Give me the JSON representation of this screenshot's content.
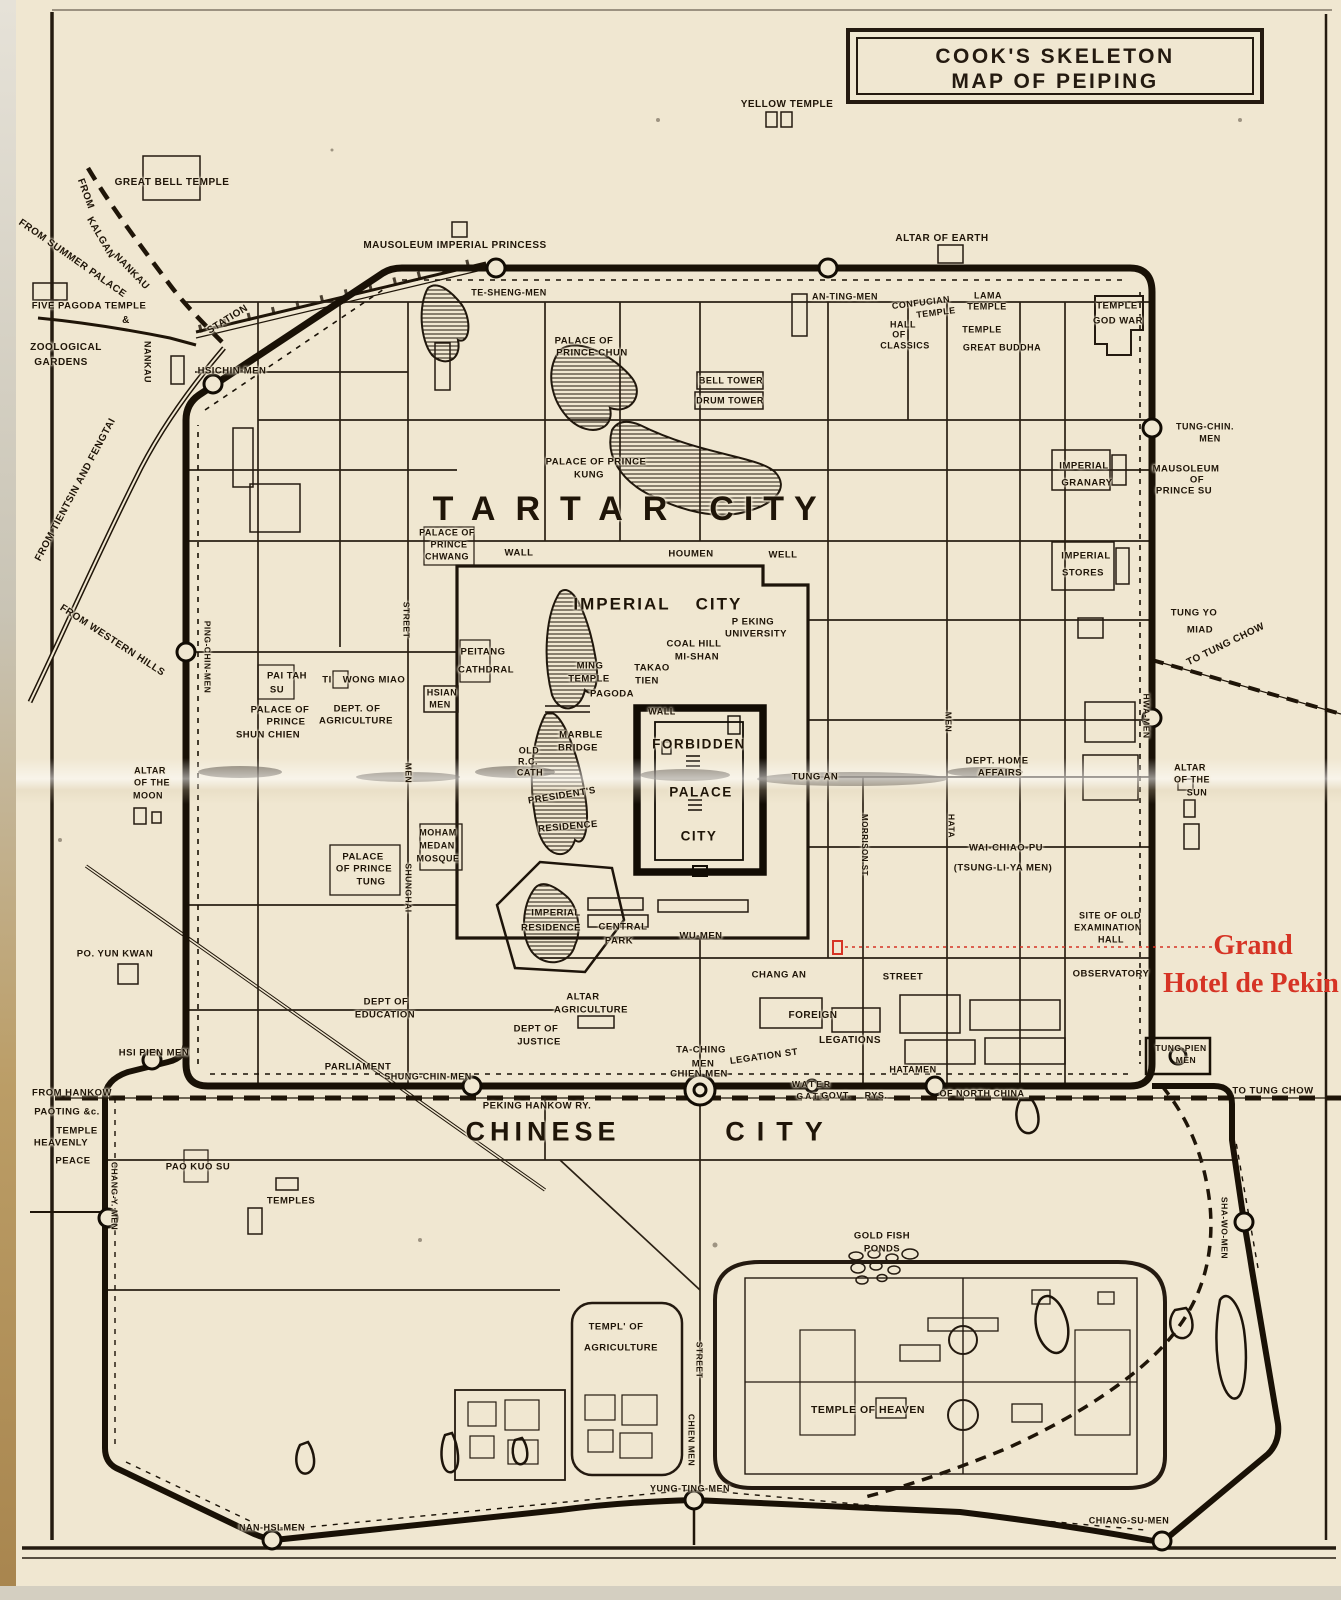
{
  "page": {
    "paper": "#f0e7d1",
    "ink": "#1f1508",
    "red": "#d63425"
  },
  "title": {
    "line1": "COOK'S SKELETON",
    "line2": "MAP OF PEIPING"
  },
  "hotel": {
    "line1": "Grand",
    "line2": "Hotel de Pekin"
  },
  "labels": [
    {
      "t": "YELLOW TEMPLE",
      "x": 787,
      "y": 105,
      "s": 10
    },
    {
      "t": "GREAT BELL TEMPLE",
      "x": 172,
      "y": 183,
      "s": 10
    },
    {
      "t": "MAUSOLEUM IMPERIAL PRINCESS",
      "x": 455,
      "y": 246,
      "s": 10
    },
    {
      "t": "ALTAR OF EARTH",
      "x": 942,
      "y": 239,
      "s": 10
    },
    {
      "t": "FROM",
      "x": 85,
      "y": 194,
      "s": 10,
      "r": 70
    },
    {
      "t": "KALGAN",
      "x": 100,
      "y": 238,
      "s": 10,
      "r": 60
    },
    {
      "t": "NANKAU",
      "x": 131,
      "y": 272,
      "s": 10,
      "r": 46
    },
    {
      "t": "FROM SUMMER PALACE",
      "x": 72,
      "y": 259,
      "s": 10,
      "r": 35
    },
    {
      "t": "&",
      "x": 126,
      "y": 321,
      "s": 10
    },
    {
      "t": "FIVE PAGODA TEMPLE",
      "x": 89,
      "y": 306,
      "s": 9.5
    },
    {
      "t": "ZOOLOGICAL",
      "x": 66,
      "y": 348,
      "s": 10
    },
    {
      "t": "GARDENS",
      "x": 61,
      "y": 363,
      "s": 10
    },
    {
      "t": "STATION",
      "x": 228,
      "y": 320,
      "s": 10,
      "r": -32
    },
    {
      "t": "NANKAU",
      "x": 147,
      "y": 362,
      "s": 9,
      "v": 1
    },
    {
      "t": "HSICHIN-MEN",
      "x": 232,
      "y": 371,
      "s": 9.5
    },
    {
      "t": "FROM TIENTSIN AND FENGTAI",
      "x": 76,
      "y": 490,
      "s": 10,
      "r": -62
    },
    {
      "t": "FROM WESTERN HILLS",
      "x": 112,
      "y": 641,
      "s": 10,
      "r": 33
    },
    {
      "t": "TE-SHENG-MEN",
      "x": 509,
      "y": 293,
      "s": 9
    },
    {
      "t": "AN-TING-MEN",
      "x": 845,
      "y": 297,
      "s": 9
    },
    {
      "t": "CONFUCIAN",
      "x": 921,
      "y": 303,
      "s": 9,
      "r": -7
    },
    {
      "t": "TEMPLE",
      "x": 936,
      "y": 313,
      "s": 9,
      "r": -7
    },
    {
      "t": "LAMA",
      "x": 988,
      "y": 296,
      "s": 9
    },
    {
      "t": "TEMPLE",
      "x": 987,
      "y": 307,
      "s": 9
    },
    {
      "t": "HALL",
      "x": 903,
      "y": 325,
      "s": 9
    },
    {
      "t": "OF",
      "x": 899,
      "y": 335,
      "s": 9
    },
    {
      "t": "CLASSICS",
      "x": 905,
      "y": 346,
      "s": 9
    },
    {
      "t": "TEMPLE",
      "x": 982,
      "y": 330,
      "s": 9
    },
    {
      "t": "GREAT  BUDDHA",
      "x": 1002,
      "y": 348,
      "s": 9
    },
    {
      "t": "TEMPLE",
      "x": 1117,
      "y": 306,
      "s": 9.5
    },
    {
      "t": "GOD WAR",
      "x": 1118,
      "y": 321,
      "s": 9.5
    },
    {
      "t": "TUNG-CHIN.",
      "x": 1205,
      "y": 427,
      "s": 9
    },
    {
      "t": "MEN",
      "x": 1210,
      "y": 439,
      "s": 9
    },
    {
      "t": "MAUSOLEUM",
      "x": 1186,
      "y": 469,
      "s": 9.5
    },
    {
      "t": "OF",
      "x": 1197,
      "y": 480,
      "s": 9.5
    },
    {
      "t": "PRINCE SU",
      "x": 1184,
      "y": 491,
      "s": 9.5
    },
    {
      "t": "IMPERIAL",
      "x": 1084,
      "y": 466,
      "s": 9.5
    },
    {
      "t": "GRANARY",
      "x": 1087,
      "y": 483,
      "s": 9.5
    },
    {
      "t": "IMPERIAL",
      "x": 1086,
      "y": 556,
      "s": 9.5
    },
    {
      "t": "STORES",
      "x": 1083,
      "y": 573,
      "s": 9.5
    },
    {
      "t": "TUNG YO",
      "x": 1194,
      "y": 613,
      "s": 9.5
    },
    {
      "t": "MIAD",
      "x": 1200,
      "y": 630,
      "s": 9.5
    },
    {
      "t": "TO TUNG CHOW",
      "x": 1226,
      "y": 645,
      "s": 10,
      "r": -26
    },
    {
      "t": "HWA-MEN",
      "x": 1146,
      "y": 716,
      "s": 8.5,
      "v": 1
    },
    {
      "t": "TARTAR",
      "x": 560,
      "y": 509,
      "s": 34,
      "ls": 20
    },
    {
      "t": "CITY",
      "x": 768,
      "y": 509,
      "s": 34,
      "ls": 10
    },
    {
      "t": "PALACE OF",
      "x": 584,
      "y": 341,
      "s": 9.5
    },
    {
      "t": "PRINCE CHUN",
      "x": 592,
      "y": 353,
      "s": 9.5
    },
    {
      "t": "BELL TOWER",
      "x": 731,
      "y": 381,
      "s": 9
    },
    {
      "t": "DRUM TOWER",
      "x": 730,
      "y": 401,
      "s": 9
    },
    {
      "t": "PALACE OF PRINCE",
      "x": 596,
      "y": 462,
      "s": 9.5
    },
    {
      "t": "KUNG",
      "x": 589,
      "y": 475,
      "s": 9.5
    },
    {
      "t": "PALACE OF",
      "x": 447,
      "y": 533,
      "s": 9
    },
    {
      "t": "PRINCE",
      "x": 449,
      "y": 545,
      "s": 9
    },
    {
      "t": "CHWANG",
      "x": 447,
      "y": 557,
      "s": 9
    },
    {
      "t": "WALL",
      "x": 519,
      "y": 553,
      "s": 9.5
    },
    {
      "t": "HOUMEN",
      "x": 691,
      "y": 554,
      "s": 9.5
    },
    {
      "t": "WELL",
      "x": 783,
      "y": 555,
      "s": 9.5
    },
    {
      "t": "IMPERIAL",
      "x": 622,
      "y": 604,
      "s": 17,
      "ls": 2
    },
    {
      "t": "CITY",
      "x": 719,
      "y": 604,
      "s": 17,
      "ls": 2
    },
    {
      "t": "P EKING",
      "x": 753,
      "y": 622,
      "s": 9.5
    },
    {
      "t": "UNIVERSITY",
      "x": 756,
      "y": 634,
      "s": 9.5
    },
    {
      "t": "COAL HILL",
      "x": 694,
      "y": 644,
      "s": 9.5
    },
    {
      "t": "MI-SHAN",
      "x": 697,
      "y": 657,
      "s": 9.5
    },
    {
      "t": "TAKAO",
      "x": 652,
      "y": 668,
      "s": 9.5
    },
    {
      "t": "TIEN",
      "x": 647,
      "y": 681,
      "s": 9.5
    },
    {
      "t": "MING",
      "x": 590,
      "y": 666,
      "s": 9.5
    },
    {
      "t": "TEMPLE",
      "x": 589,
      "y": 679,
      "s": 9.5
    },
    {
      "t": "PAGODA",
      "x": 612,
      "y": 694,
      "s": 9.5
    },
    {
      "t": "PEITANG",
      "x": 483,
      "y": 652,
      "s": 9.5
    },
    {
      "t": "CATHDRAL",
      "x": 486,
      "y": 670,
      "s": 9.5
    },
    {
      "t": "HSIAN",
      "x": 442,
      "y": 693,
      "s": 9
    },
    {
      "t": "MEN",
      "x": 440,
      "y": 705,
      "s": 9
    },
    {
      "t": "PAI TAH",
      "x": 287,
      "y": 676,
      "s": 9.5
    },
    {
      "t": "SU",
      "x": 277,
      "y": 690,
      "s": 9.5
    },
    {
      "t": "TI",
      "x": 327,
      "y": 680,
      "s": 9.5
    },
    {
      "t": "WONG MIAO",
      "x": 374,
      "y": 680,
      "s": 9.5
    },
    {
      "t": "PALACE OF",
      "x": 280,
      "y": 710,
      "s": 9.5
    },
    {
      "t": "PRINCE",
      "x": 286,
      "y": 722,
      "s": 9.5
    },
    {
      "t": "SHUN CHIEN",
      "x": 268,
      "y": 735,
      "s": 9.5
    },
    {
      "t": "DEPT. OF",
      "x": 357,
      "y": 709,
      "s": 9.5
    },
    {
      "t": "AGRICULTURE",
      "x": 356,
      "y": 721,
      "s": 9.5
    },
    {
      "t": "PING-CHIN-MEN",
      "x": 207,
      "y": 657,
      "s": 8.5,
      "v": 1
    },
    {
      "t": "STREET",
      "x": 406,
      "y": 620,
      "s": 8.5,
      "v": 1
    },
    {
      "t": "ALTAR",
      "x": 150,
      "y": 771,
      "s": 9
    },
    {
      "t": "OF THE",
      "x": 152,
      "y": 783,
      "s": 9
    },
    {
      "t": "MOON",
      "x": 148,
      "y": 796,
      "s": 9
    },
    {
      "t": "MEN",
      "x": 408,
      "y": 773,
      "s": 8.5,
      "v": 1
    },
    {
      "t": "SHUNGHAI",
      "x": 408,
      "y": 888,
      "s": 8.5,
      "v": 1
    },
    {
      "t": "MOHAM",
      "x": 438,
      "y": 833,
      "s": 9
    },
    {
      "t": "MEDAN",
      "x": 437,
      "y": 846,
      "s": 9
    },
    {
      "t": "MOSQUE",
      "x": 438,
      "y": 859,
      "s": 9
    },
    {
      "t": "PALACE",
      "x": 363,
      "y": 857,
      "s": 9.5
    },
    {
      "t": "OF PRINCE",
      "x": 364,
      "y": 869,
      "s": 9.5
    },
    {
      "t": "TUNG",
      "x": 371,
      "y": 882,
      "s": 9.5
    },
    {
      "t": "OLD",
      "x": 529,
      "y": 751,
      "s": 9
    },
    {
      "t": "R.C.",
      "x": 528,
      "y": 762,
      "s": 9
    },
    {
      "t": "CATH",
      "x": 530,
      "y": 773,
      "s": 9
    },
    {
      "t": "MARBLE",
      "x": 581,
      "y": 735,
      "s": 9.5
    },
    {
      "t": "BRIDGE",
      "x": 578,
      "y": 748,
      "s": 9.5
    },
    {
      "t": "PRESIDENT'S",
      "x": 562,
      "y": 796,
      "s": 9.5,
      "r": -9
    },
    {
      "t": "RESIDENCE",
      "x": 568,
      "y": 827,
      "s": 9.5,
      "r": -5
    },
    {
      "t": "WALL",
      "x": 662,
      "y": 712,
      "s": 9
    },
    {
      "t": "FORBIDDEN",
      "x": 699,
      "y": 744,
      "s": 13.5,
      "ls": 1.5
    },
    {
      "t": "PALACE",
      "x": 701,
      "y": 792,
      "s": 13.5,
      "ls": 1.5
    },
    {
      "t": "CITY",
      "x": 699,
      "y": 836,
      "s": 13.5,
      "ls": 1.5
    },
    {
      "t": "TUNG AN",
      "x": 815,
      "y": 777,
      "s": 9.5
    },
    {
      "t": "MEN",
      "x": 948,
      "y": 722,
      "s": 8.5,
      "v": 1
    },
    {
      "t": "HATA",
      "x": 951,
      "y": 826,
      "s": 8.5,
      "v": 1
    },
    {
      "t": "MORRISON ST",
      "x": 864,
      "y": 845,
      "s": 8,
      "v": 1
    },
    {
      "t": "DEPT. HOME",
      "x": 997,
      "y": 761,
      "s": 9.5
    },
    {
      "t": "AFFAIRS",
      "x": 1000,
      "y": 773,
      "s": 9.5
    },
    {
      "t": "WAI-CHIAO-PU",
      "x": 1006,
      "y": 848,
      "s": 9.5
    },
    {
      "t": "(TSUNG-LI-YA MEN)",
      "x": 1003,
      "y": 868,
      "s": 9.5
    },
    {
      "t": "IMPERIAL",
      "x": 556,
      "y": 913,
      "s": 9.5
    },
    {
      "t": "RESIDENCE",
      "x": 551,
      "y": 928,
      "s": 9.5
    },
    {
      "t": "CENTRAL",
      "x": 623,
      "y": 927,
      "s": 9.5
    },
    {
      "t": "PARK",
      "x": 619,
      "y": 941,
      "s": 9.5
    },
    {
      "t": "WU-MEN",
      "x": 701,
      "y": 936,
      "s": 9.5
    },
    {
      "t": "CHANG AN",
      "x": 779,
      "y": 975,
      "s": 9.5
    },
    {
      "t": "STREET",
      "x": 903,
      "y": 977,
      "s": 9.5
    },
    {
      "t": "ALTAR",
      "x": 583,
      "y": 997,
      "s": 9.5
    },
    {
      "t": "AGRICULTURE",
      "x": 591,
      "y": 1010,
      "s": 9.5
    },
    {
      "t": "DEPT OF",
      "x": 536,
      "y": 1029,
      "s": 9.5
    },
    {
      "t": "JUSTICE",
      "x": 539,
      "y": 1042,
      "s": 9.5
    },
    {
      "t": "TA-CHING",
      "x": 701,
      "y": 1050,
      "s": 9.5
    },
    {
      "t": "MEN",
      "x": 703,
      "y": 1064,
      "s": 9.5
    },
    {
      "t": "LEGATION ST",
      "x": 764,
      "y": 1057,
      "s": 9.5,
      "r": -8
    },
    {
      "t": "FOREIGN",
      "x": 813,
      "y": 1016,
      "s": 10
    },
    {
      "t": "LEGATIONS",
      "x": 850,
      "y": 1041,
      "s": 10
    },
    {
      "t": "DEPT OF",
      "x": 386,
      "y": 1002,
      "s": 9.5
    },
    {
      "t": "EDUCATION",
      "x": 385,
      "y": 1015,
      "s": 9.5
    },
    {
      "t": "PARLIAMENT",
      "x": 358,
      "y": 1067,
      "s": 9.5
    },
    {
      "t": "PO. YUN KWAN",
      "x": 115,
      "y": 954,
      "s": 9.5
    },
    {
      "t": "HSI PIEN MEN",
      "x": 154,
      "y": 1053,
      "s": 9.5
    },
    {
      "t": "SITE OF OLD",
      "x": 1110,
      "y": 916,
      "s": 9
    },
    {
      "t": "EXAMINATION",
      "x": 1108,
      "y": 928,
      "s": 9
    },
    {
      "t": "HALL",
      "x": 1111,
      "y": 940,
      "s": 9
    },
    {
      "t": "OBSERVATORY",
      "x": 1111,
      "y": 974,
      "s": 9.5
    },
    {
      "t": "ALTAR",
      "x": 1190,
      "y": 768,
      "s": 9
    },
    {
      "t": "OF THE",
      "x": 1192,
      "y": 780,
      "s": 9
    },
    {
      "t": "SUN",
      "x": 1197,
      "y": 793,
      "s": 9
    },
    {
      "t": "SHUNG-CHIN-MEN",
      "x": 428,
      "y": 1077,
      "s": 9
    },
    {
      "t": "CHIEN MEN",
      "x": 699,
      "y": 1074,
      "s": 9.5
    },
    {
      "t": "WATER",
      "x": 812,
      "y": 1084,
      "s": 8.5,
      "ls": 2
    },
    {
      "t": "GATE",
      "x": 812,
      "y": 1096,
      "s": 8.5,
      "ls": 2
    },
    {
      "t": "HATAMEN",
      "x": 913,
      "y": 1070,
      "s": 9
    },
    {
      "t": "GOVT.",
      "x": 836,
      "y": 1096,
      "s": 9
    },
    {
      "t": "RYS.",
      "x": 876,
      "y": 1096,
      "s": 9
    },
    {
      "t": "OF NORTH CHINA",
      "x": 982,
      "y": 1094,
      "s": 9
    },
    {
      "t": "TUNG-PIEN",
      "x": 1181,
      "y": 1048,
      "s": 8.5
    },
    {
      "t": "MEN",
      "x": 1186,
      "y": 1060,
      "s": 8.5
    },
    {
      "t": "TO TUNG CHOW",
      "x": 1273,
      "y": 1091,
      "s": 9.5
    },
    {
      "t": "PEKING HANKOW RY.",
      "x": 537,
      "y": 1106,
      "s": 9.5
    },
    {
      "t": "FROM HANKOW",
      "x": 72,
      "y": 1093,
      "s": 9.5
    },
    {
      "t": "PAOTING &c.",
      "x": 67,
      "y": 1112,
      "s": 9.5
    },
    {
      "t": "TEMPLE",
      "x": 77,
      "y": 1131,
      "s": 9.5
    },
    {
      "t": "HEAVENLY",
      "x": 61,
      "y": 1143,
      "s": 9.5
    },
    {
      "t": "PEACE",
      "x": 73,
      "y": 1161,
      "s": 9.5
    },
    {
      "t": "CHINESE",
      "x": 543,
      "y": 1132,
      "s": 27,
      "ls": 5
    },
    {
      "t": "CITY",
      "x": 780,
      "y": 1132,
      "s": 27,
      "ls": 12
    },
    {
      "t": "CHANG-Y. MEN",
      "x": 114,
      "y": 1196,
      "s": 8.5,
      "v": 1
    },
    {
      "t": "PAO KUO SU",
      "x": 198,
      "y": 1167,
      "s": 9.5
    },
    {
      "t": "TEMPLES",
      "x": 291,
      "y": 1201,
      "s": 9.5
    },
    {
      "t": "GOLD FISH",
      "x": 882,
      "y": 1236,
      "s": 9.5
    },
    {
      "t": "PONDS",
      "x": 882,
      "y": 1249,
      "s": 9.5
    },
    {
      "t": "TEMPL' OF",
      "x": 616,
      "y": 1327,
      "s": 9.5
    },
    {
      "t": "AGRICULTURE",
      "x": 621,
      "y": 1348,
      "s": 9.5
    },
    {
      "t": "STREET",
      "x": 699,
      "y": 1360,
      "s": 8.5,
      "v": 1
    },
    {
      "t": "CHIEN MEN",
      "x": 691,
      "y": 1440,
      "s": 8.5,
      "v": 1
    },
    {
      "t": "TEMPLE OF HEAVEN",
      "x": 868,
      "y": 1410,
      "s": 10.5
    },
    {
      "t": "YUNG-TING-MEN",
      "x": 690,
      "y": 1489,
      "s": 9
    },
    {
      "t": "NAN-HSI-MEN",
      "x": 272,
      "y": 1528,
      "s": 9
    },
    {
      "t": "CHIANG-SU-MEN",
      "x": 1129,
      "y": 1521,
      "s": 9
    },
    {
      "t": "SHA-WO-MEN",
      "x": 1224,
      "y": 1228,
      "s": 8.5,
      "v": 1
    }
  ]
}
